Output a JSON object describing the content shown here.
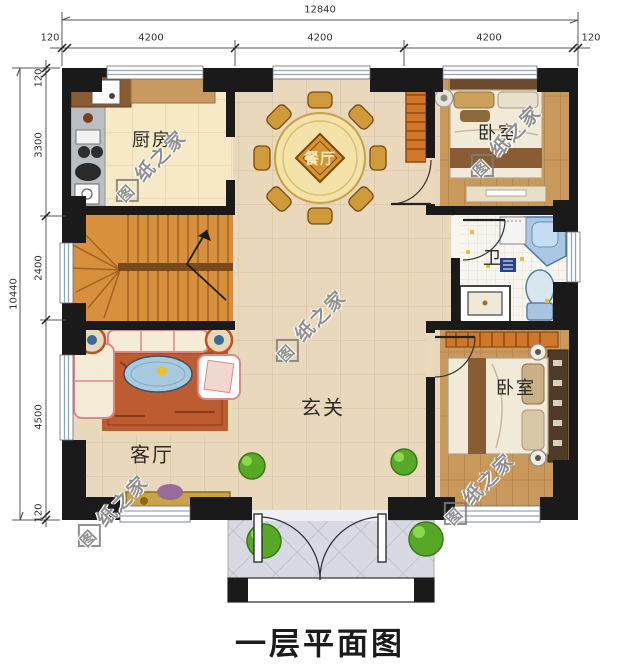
{
  "title": "一层平面图",
  "watermark": {
    "boxed_char": "图",
    "text_rest": "纸之家",
    "full_text": "图纸之家"
  },
  "dimensions": {
    "top": {
      "total": "12840",
      "segments": [
        "120",
        "4200",
        "4200",
        "4200",
        "120"
      ]
    },
    "left": {
      "total": "10440",
      "segments": [
        "120",
        "3300",
        "2400",
        "4500",
        "120"
      ]
    }
  },
  "rooms": {
    "kitchen": {
      "label": "厨房"
    },
    "dining": {
      "label": "餐厅"
    },
    "bedroom_top": {
      "label": "卧室"
    },
    "bathroom": {
      "label": "卫"
    },
    "hallway": {
      "label": "玄关"
    },
    "living": {
      "label": "客厅"
    },
    "bedroom_bottom": {
      "label": "卧室"
    }
  },
  "colors": {
    "wall": "#1a1a1a",
    "floor_beige": "#e9d8bb",
    "floor_kitchen": "#f5e9c6",
    "wood_floor": "#c9995c",
    "stairs": "#d8903c",
    "bath_fixture": "#aac8e6",
    "porch_tile": "#d9d9e3",
    "dining_table": "#d8942e",
    "rug": "#bd5c30",
    "plant": "#58a828",
    "watermark": "#7d7d7d"
  }
}
